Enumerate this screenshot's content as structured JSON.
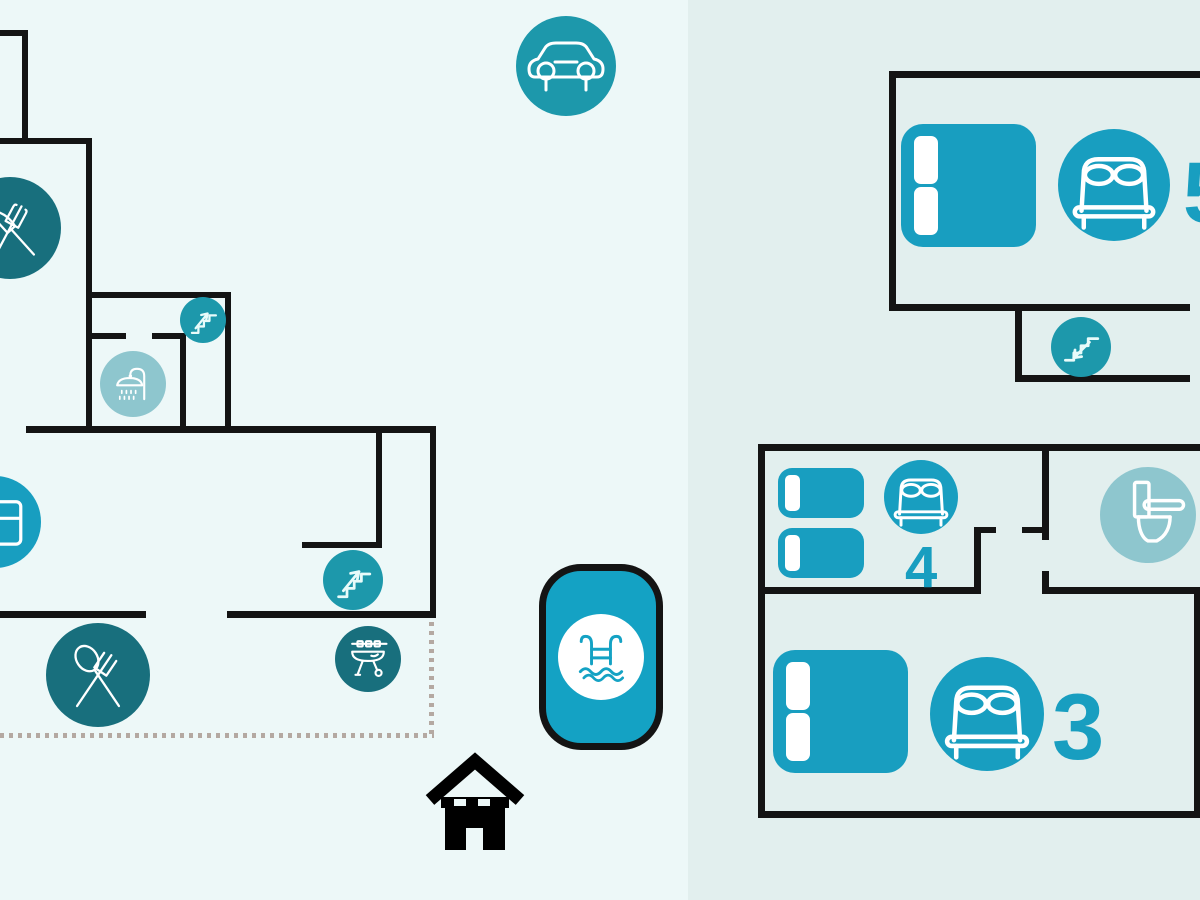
{
  "title": "holiday-home-floor-plan",
  "colors": {
    "left_panel_bg": "#edf8f8",
    "right_panel_bg": "#e2efee",
    "wall": "#141414",
    "teal": "#189ec0",
    "teal_alt": "#1d98ab",
    "dark_teal": "#186f7d",
    "light_teal": "#8ec6ce",
    "dotted_line": "#b4a9a2",
    "pool_fill": "#14a2c4",
    "house": "#000000"
  },
  "left_panel": {
    "name": "ground-floor-plan",
    "icons": [
      {
        "name": "kitchen-icon"
      },
      {
        "name": "fridge-icon"
      },
      {
        "name": "stairs-up-icon"
      },
      {
        "name": "shower-icon"
      },
      {
        "name": "stairs-up-icon"
      },
      {
        "name": "dining-icon"
      },
      {
        "name": "bbq-icon"
      },
      {
        "name": "car-icon"
      },
      {
        "name": "pool-icon"
      },
      {
        "name": "house-icon"
      }
    ]
  },
  "right_panel": {
    "name": "upper-floor-plan",
    "icons": [
      {
        "name": "double-bed-icon"
      },
      {
        "name": "stairs-down-icon"
      },
      {
        "name": "double-bed-icon"
      },
      {
        "name": "toilet-icon"
      },
      {
        "name": "double-bed-icon"
      }
    ],
    "rooms": [
      {
        "name": "bedroom-top",
        "capacity": "5"
      },
      {
        "name": "bedroom-middle",
        "capacity": "4"
      },
      {
        "name": "bedroom-bottom",
        "capacity": "3"
      }
    ]
  }
}
